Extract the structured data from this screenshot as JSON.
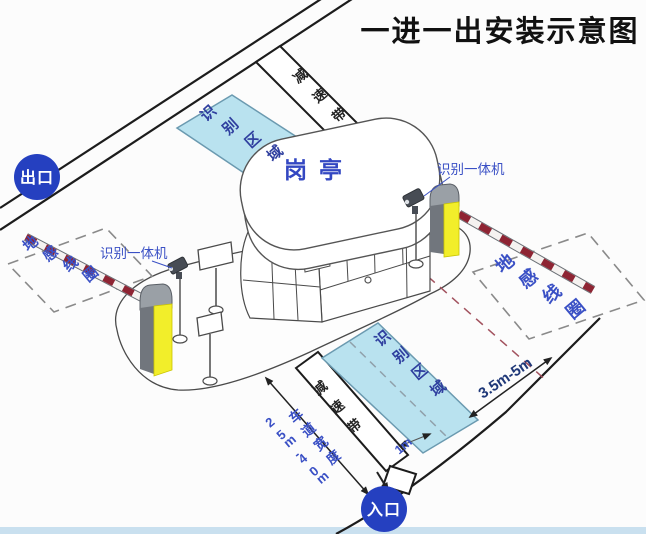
{
  "title": "一进一出安装示意图",
  "badges": {
    "exit": "出口",
    "entrance": "入口"
  },
  "booth": {
    "label": "岗亭"
  },
  "zones": {
    "recognition_exit": "识别区域",
    "recognition_entry": "识别区域",
    "coil_exit": "地感线圈",
    "coil_entry": "地感线圈"
  },
  "bands": {
    "exit": "减速带",
    "entry": "减速带"
  },
  "devices": {
    "reader_exit": "识别一体机",
    "reader_entry": "识别一体机"
  },
  "measurements": {
    "lane_width_label": "车道宽度",
    "lane_width_value": "2.5m-4.0m",
    "coil_distance": "3.5m-5m",
    "zone_offset": "1m"
  },
  "colors": {
    "badge_blue": "#2540c0",
    "zone_fill": "#b9e2ef",
    "machine_yellow": "#f2ee2a",
    "arm_red": "#8e2433",
    "label_blue": "#3a50c5"
  }
}
